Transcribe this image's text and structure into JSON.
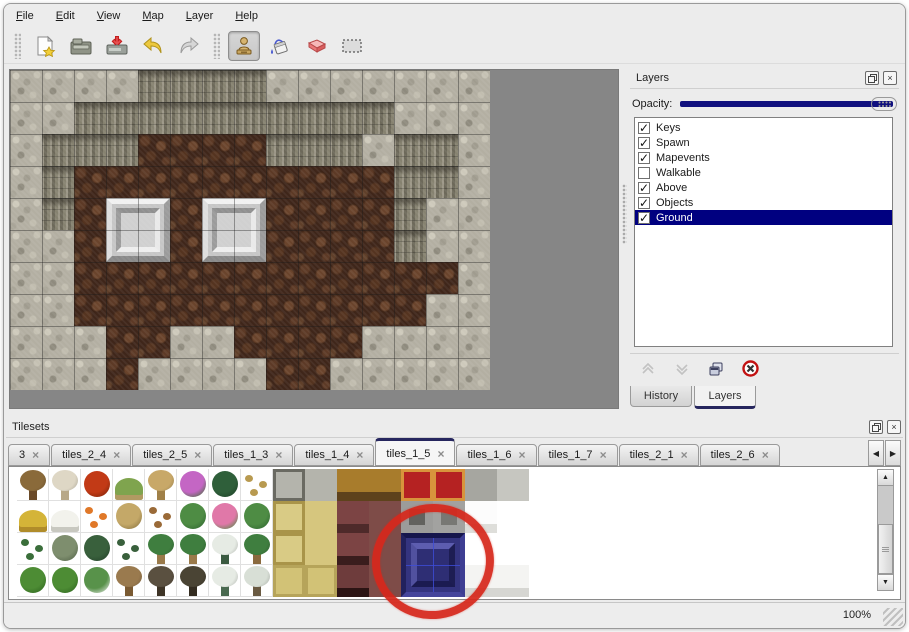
{
  "menu": {
    "items": [
      {
        "label": "File"
      },
      {
        "label": "Edit"
      },
      {
        "label": "View"
      },
      {
        "label": "Map"
      },
      {
        "label": "Layer"
      },
      {
        "label": "Help"
      }
    ]
  },
  "toolbar": {
    "buttons": [
      "new",
      "open",
      "save",
      "undo",
      "redo"
    ],
    "tools": [
      "stamp",
      "fill",
      "eraser",
      "select"
    ],
    "active_tool": "stamp"
  },
  "icons": {
    "check": "✓",
    "close": "×",
    "left": "◀",
    "right": "▶",
    "up": "▲",
    "down": "▼"
  },
  "map": {
    "rows": [
      "LLLLCCCCLLLLLLL",
      "LLCCCCCCCCCCLLL",
      "LCCCFFFFCCCLCCL",
      "LCFFFFFFFFFFCCL",
      "LCFPPFPPFFFFCLL",
      "LLFPPFPPFFFFCLL",
      "LLFFFFFFFFFFFFL",
      "LLFFFFFFFFFFFLL",
      "LLLFFLLFFFFLLLL",
      "LLLFLLLLFFLLLLL"
    ],
    "pedestals": [
      {
        "col": 3,
        "row": 4
      },
      {
        "col": 6,
        "row": 4
      }
    ]
  },
  "layers_panel": {
    "title": "Layers",
    "opacity_label": "Opacity:",
    "opacity_percent": 100,
    "layers": [
      {
        "name": "Keys",
        "checked": true,
        "selected": false
      },
      {
        "name": "Spawn",
        "checked": true,
        "selected": false
      },
      {
        "name": "Mapevents",
        "checked": true,
        "selected": false
      },
      {
        "name": "Walkable",
        "checked": false,
        "selected": false
      },
      {
        "name": "Above",
        "checked": true,
        "selected": false
      },
      {
        "name": "Objects",
        "checked": true,
        "selected": false
      },
      {
        "name": "Ground",
        "checked": true,
        "selected": true
      }
    ],
    "buttons": [
      "move-up",
      "move-down",
      "duplicate",
      "delete"
    ],
    "tabs": [
      {
        "label": "History",
        "active": false
      },
      {
        "label": "Layers",
        "active": true
      }
    ]
  },
  "tilesets_panel": {
    "title": "Tilesets",
    "tabs": [
      {
        "label": "3",
        "active": false
      },
      {
        "label": "tiles_2_4",
        "active": false
      },
      {
        "label": "tiles_2_5",
        "active": false
      },
      {
        "label": "tiles_1_3",
        "active": false
      },
      {
        "label": "tiles_1_4",
        "active": false
      },
      {
        "label": "tiles_1_5",
        "active": true
      },
      {
        "label": "tiles_1_6",
        "active": false
      },
      {
        "label": "tiles_1_7",
        "active": false
      },
      {
        "label": "tiles_2_1",
        "active": false
      },
      {
        "label": "tiles_2_6",
        "active": false
      }
    ],
    "rows": [
      "T1 T2 FL1 ST TR FL2 PL1 SP1 SC SN TG TG CR CR SG SL",
      "MD1 MD2 FL3 GR1 LV LP FL4 LP TB TW SM MR MF MG WF WH",
      "SP2 BU1 BU2 BU3 PM PM PN PMT TB TW SM2 MR WH WH WH WH",
      "BC BC BS TD TK TK2 PN2 TS TH TH SM3 MR WH WH WR WR"
    ],
    "palette": {
      "T1": {
        "kind": "tree",
        "c": "#8a6a3a",
        "c2": "#6a4a28"
      },
      "T2": {
        "kind": "tree",
        "c": "#ded7c5",
        "c2": "#b8a888"
      },
      "FL1": {
        "kind": "canopy",
        "c": "#c23a16",
        "c2": "#7e2408"
      },
      "ST": {
        "kind": "mound",
        "c": "#7fa44e",
        "c2": "#b19a62"
      },
      "TR": {
        "kind": "tree",
        "c": "#c8a868",
        "c2": "#a08048"
      },
      "FL2": {
        "kind": "canopy",
        "c": "#c466c4",
        "c2": "#44703a"
      },
      "PL1": {
        "kind": "canopy",
        "c": "#2f5f3a",
        "c2": "#1e4228"
      },
      "SP1": {
        "kind": "small",
        "c": "#b89a50"
      },
      "MD1": {
        "kind": "mound",
        "c": "#d4b438",
        "c2": "#b08c2a"
      },
      "MD2": {
        "kind": "mound",
        "c": "#f2f2ec",
        "c2": "#c8c8c0"
      },
      "FL3": {
        "kind": "small",
        "c": "#e07828"
      },
      "GR1": {
        "kind": "canopy",
        "c": "#c4a868",
        "c2": "#8a7440"
      },
      "LV": {
        "kind": "small",
        "c": "#9a6a38"
      },
      "LP": {
        "kind": "canopy",
        "c": "#4e8c44",
        "c2": "#2f6630"
      },
      "FL4": {
        "kind": "canopy",
        "c": "#e078a8",
        "c2": "#4e8c44"
      },
      "SP2": {
        "kind": "small",
        "c": "#3a6e3a"
      },
      "BU1": {
        "kind": "canopy",
        "c": "#7e8e6e",
        "c2": "#55654a"
      },
      "BU2": {
        "kind": "canopy",
        "c": "#39603c",
        "c2": "#24422a"
      },
      "BU3": {
        "kind": "small",
        "c": "#39603c"
      },
      "PM": {
        "kind": "tree",
        "c": "#3f7e3f",
        "c2": "#9a7a4a"
      },
      "PN": {
        "kind": "tree",
        "c": "#e6ebe4",
        "c2": "#3a5a40"
      },
      "PMT": {
        "kind": "tree",
        "c": "#3f7e3f",
        "c2": "#8a6a3e"
      },
      "BC": {
        "kind": "canopy",
        "c": "#4d8c34",
        "c2": "#2f6620"
      },
      "BS": {
        "kind": "canopy",
        "c": "#58924a",
        "c2": "#dfe5dd"
      },
      "TD": {
        "kind": "tree",
        "c": "#9a7a4e",
        "c2": "#7a5a32"
      },
      "TK": {
        "kind": "tree",
        "c": "#5a5040",
        "c2": "#3e3426"
      },
      "TK2": {
        "kind": "tree",
        "c": "#4a4434",
        "c2": "#332c20"
      },
      "PN2": {
        "kind": "tree",
        "c": "#e6ebe4",
        "c2": "#4a6a50"
      },
      "TS": {
        "kind": "tree",
        "c": "#d8dfd6",
        "c2": "#6a5a42"
      },
      "SC": {
        "kind": "full",
        "c": "#b4b4ac",
        "c2": "#6a6a62"
      },
      "SN": {
        "kind": "full",
        "c": "#b4b4ac"
      },
      "TG": {
        "kind": "band",
        "c": "#a87c2c",
        "c2": "#5e421c"
      },
      "CR": {
        "kind": "full",
        "c": "#b52222",
        "c2": "#d8943c"
      },
      "SG": {
        "kind": "full",
        "c": "#a6a6a0"
      },
      "SL": {
        "kind": "full",
        "c": "#c6c6c0"
      },
      "TB": {
        "kind": "full",
        "c": "#d9cb85",
        "c2": "#a99449"
      },
      "TW": {
        "kind": "full",
        "c": "#d6c67e"
      },
      "SM": {
        "kind": "band",
        "c": "#7c4444",
        "c2": "#4e2a2a"
      },
      "MR": {
        "kind": "full",
        "c": "#7e4c48"
      },
      "MF": {
        "kind": "inset",
        "c": "#9c9c9a",
        "c2": "#62625e"
      },
      "MG": {
        "kind": "inset",
        "c": "#a2a2a0",
        "c2": "#787874"
      },
      "WF": {
        "kind": "band",
        "c": "#fcfcfc",
        "c2": "#dededa"
      },
      "WH": {
        "kind": "full",
        "c": "#ffffff"
      },
      "TH": {
        "kind": "full",
        "c": "#d2c276",
        "c2": "#b6a45a"
      },
      "SM2": {
        "kind": "band",
        "c": "#7c4444",
        "c2": "#3a1d1d"
      },
      "SM3": {
        "kind": "band",
        "c": "#6e3c3c",
        "c2": "#2c1414"
      },
      "WR": {
        "kind": "band",
        "c": "#f4f4f2",
        "c2": "#d6d6d2"
      }
    },
    "selected_tile": {
      "col": 12,
      "row": 2,
      "span": 2
    }
  },
  "status": {
    "zoom_level": "100%"
  },
  "colors": {
    "accent_navy": "#000080",
    "annotation_red": "#d7281c",
    "canvas_gray": "#868686",
    "opacity_track": "#10107e"
  }
}
